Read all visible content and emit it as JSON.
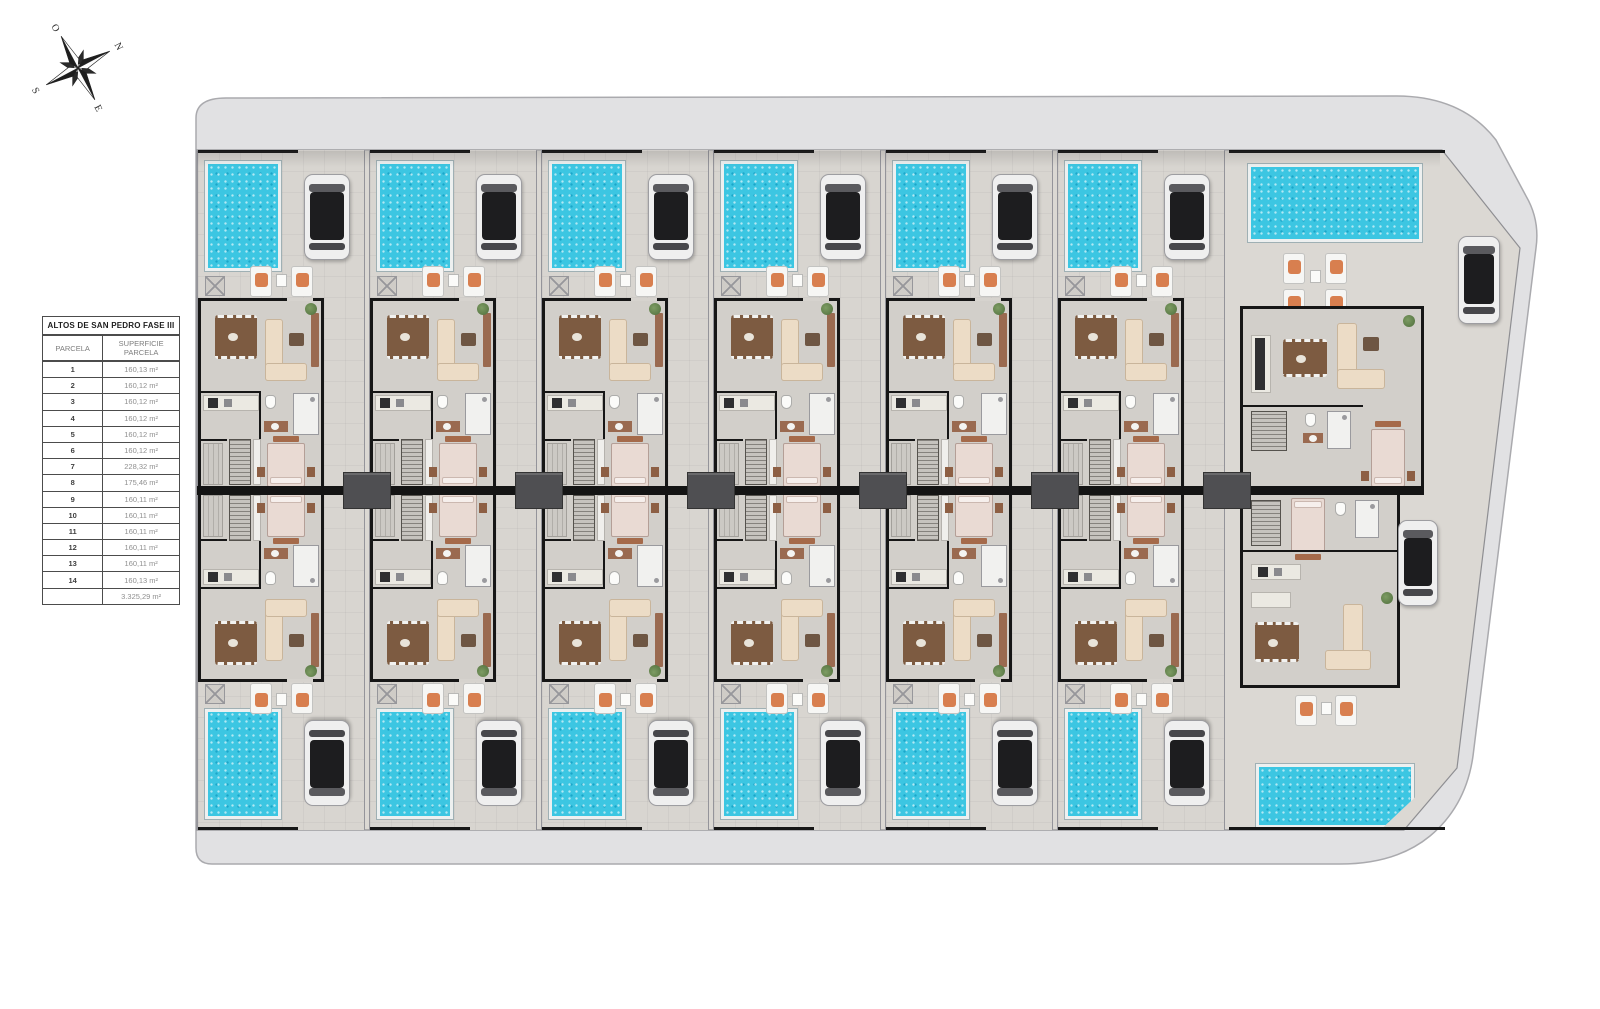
{
  "compass": {
    "north": "N",
    "east": "E",
    "south": "S",
    "west": "O"
  },
  "legend_table": {
    "title": "ALTOS DE SAN PEDRO FASE III",
    "header": {
      "parcela": "PARCELA",
      "superficie": "SUPERFICIE PARCELA"
    },
    "rows": [
      [
        "1",
        "160,13 m²"
      ],
      [
        "2",
        "160,12 m²"
      ],
      [
        "3",
        "160,12 m²"
      ],
      [
        "4",
        "160,12 m²"
      ],
      [
        "5",
        "160,12 m²"
      ],
      [
        "6",
        "160,12 m²"
      ],
      [
        "7",
        "228,32 m²"
      ],
      [
        "8",
        "175,46 m²"
      ],
      [
        "9",
        "160,11 m²"
      ],
      [
        "10",
        "160,11 m²"
      ],
      [
        "11",
        "160,11 m²"
      ],
      [
        "12",
        "160,11 m²"
      ],
      [
        "13",
        "160,11 m²"
      ],
      [
        "14",
        "160,13 m²"
      ]
    ],
    "total": "3.325,29 m²"
  },
  "plan": {
    "villa_count": 7,
    "parcel_count": 14,
    "colors": {
      "pool": "#3cc6e2",
      "road": "#e1e1e3",
      "paving": "#d8d5d0",
      "interior": "#d2cfca",
      "wall": "#161616",
      "accent_wood": "#9a6a50"
    }
  }
}
